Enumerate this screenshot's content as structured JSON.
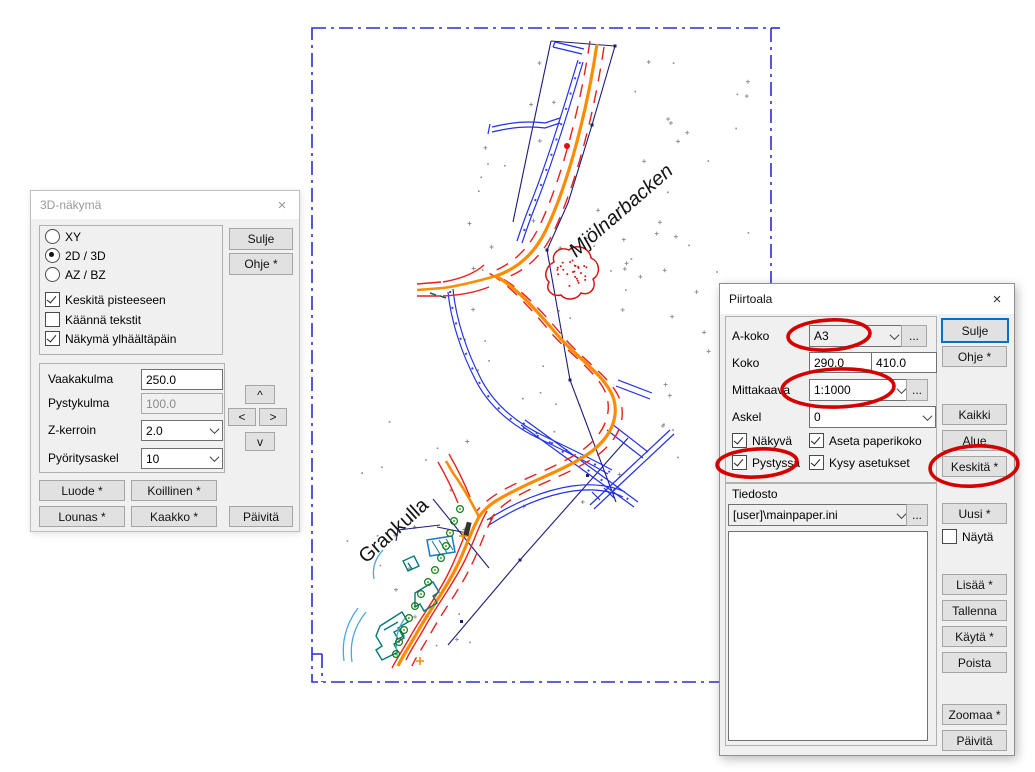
{
  "map": {
    "labels": [
      {
        "text": "Mjölnarbacken"
      },
      {
        "text": "Grankulla"
      }
    ],
    "colors": {
      "paper_border": "#2d2dd0",
      "road": "#ff8c00",
      "road_edge": "#e82020",
      "ditch_blue": "#2230e8",
      "boundary_navy": "#1c1c78",
      "terrain_points": "#8a8a8a",
      "building_teal": "#067878",
      "building_blue": "#1a78c8",
      "arc_cyan": "#4aa8d8",
      "tree_green": "#0f7d0f",
      "red_feature": "#dd1111",
      "annotation": "#d40000"
    }
  },
  "dialog_3d": {
    "title": "3D-näkymä",
    "close_label": "×",
    "radio_options": [
      {
        "label": "XY",
        "selected": false
      },
      {
        "label": "2D / 3D",
        "selected": true
      },
      {
        "label": "AZ / BZ",
        "selected": false
      }
    ],
    "checkboxes": [
      {
        "label": "Keskitä pisteeseen",
        "checked": true
      },
      {
        "label": "Käännä tekstit",
        "checked": false
      },
      {
        "label": "Näkymä ylhäältäpäin",
        "checked": true
      }
    ],
    "fields": [
      {
        "label": "Vaakakulma",
        "value": "250.0",
        "type": "input",
        "disabled": false
      },
      {
        "label": "Pystykulma",
        "value": "100.0",
        "type": "input",
        "disabled": true
      },
      {
        "label": "Z-kerroin",
        "value": "2.0",
        "type": "select"
      },
      {
        "label": "Pyöritysaskel",
        "value": "10",
        "type": "select"
      }
    ],
    "arrows": {
      "up": "^",
      "left": "<",
      "right": ">",
      "down": "v"
    },
    "buttons": {
      "sulje": "Sulje",
      "ohje": "Ohje *",
      "luode": "Luode *",
      "koillinen": "Koillinen *",
      "lounas": "Lounas *",
      "kaakko": "Kaakko *",
      "paivita": "Päivitä"
    }
  },
  "dialog_piirtoala": {
    "title": "Piirtoala",
    "close_label": "×",
    "more_label": "...",
    "fields": {
      "a_koko": {
        "label": "A-koko",
        "value": "A3"
      },
      "koko": {
        "label": "Koko",
        "width": "290.0",
        "height": "410.0"
      },
      "mittakaava": {
        "label": "Mittakaava",
        "value": "1:1000"
      },
      "askel": {
        "label": "Askel",
        "value": "0"
      }
    },
    "checkboxes": [
      {
        "label": "Näkyvä",
        "checked": true
      },
      {
        "label": "Aseta paperikoko",
        "checked": true
      },
      {
        "label": "Pystyssä",
        "checked": true
      },
      {
        "label": "Kysy asetukset",
        "checked": true
      }
    ],
    "tiedosto": {
      "label": "Tiedosto",
      "value": "[user]\\mainpaper.ini"
    },
    "nayta_checkbox": {
      "label": "Näytä",
      "checked": false
    },
    "buttons": {
      "sulje": "Sulje",
      "ohje": "Ohje *",
      "kaikki": "Kaikki",
      "alue": "Alue",
      "keskita": "Keskitä *",
      "uusi": "Uusi *",
      "lisaa": "Lisää *",
      "tallenna": "Tallenna",
      "kayta": "Käytä *",
      "poista": "Poista",
      "zoomaa": "Zoomaa *",
      "paivita": "Päivitä"
    },
    "annotated_in_red": [
      "a_koko",
      "mittakaava",
      "pystyssa",
      "keskita"
    ]
  }
}
